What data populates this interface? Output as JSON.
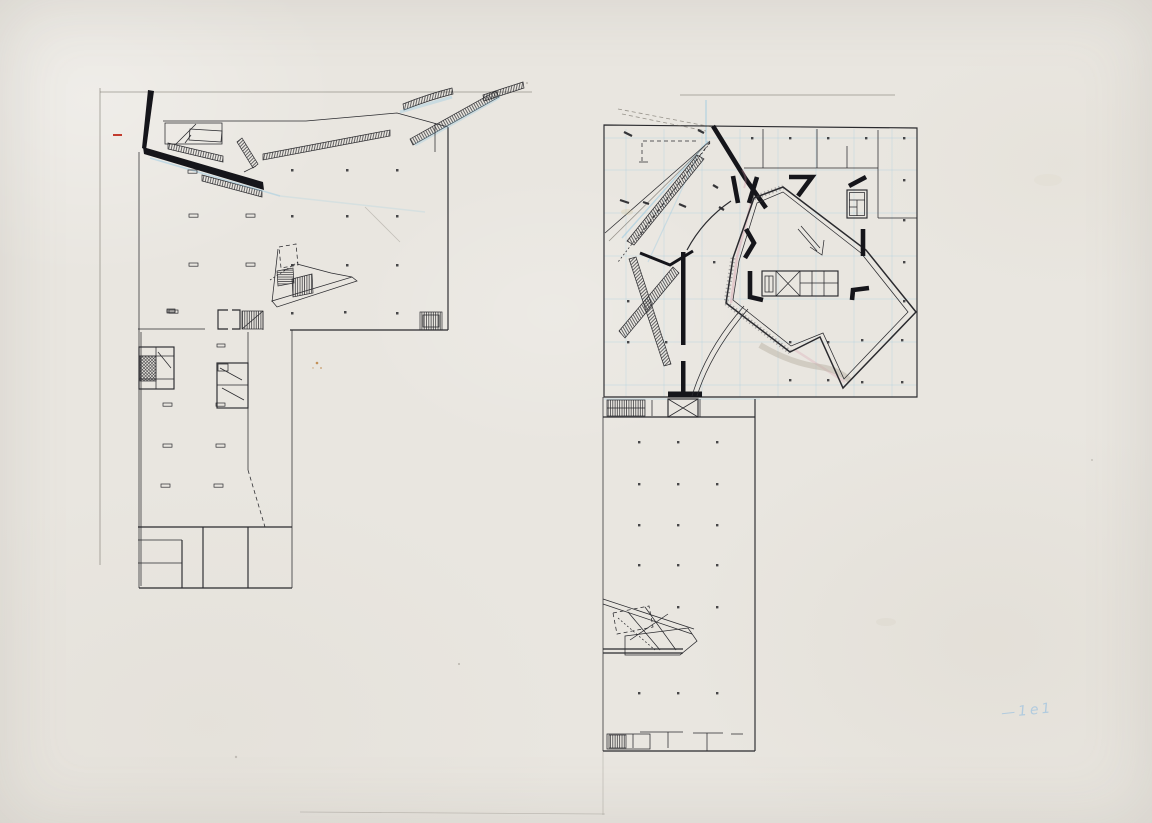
{
  "document_type": "scanned hand-drawn architectural floor plans",
  "annotation": {
    "text": "—1e1"
  },
  "colors": {
    "paper": "#e9e6e0",
    "ink": "#2a2a2e",
    "heavy": "#15151a",
    "pencil": "#6b675e",
    "cyan": "#8ec6e2",
    "pink": "#d893a4",
    "red": "#c23b2e",
    "orange": "#b97a35",
    "annotation_blue": "#9cc2e0"
  }
}
